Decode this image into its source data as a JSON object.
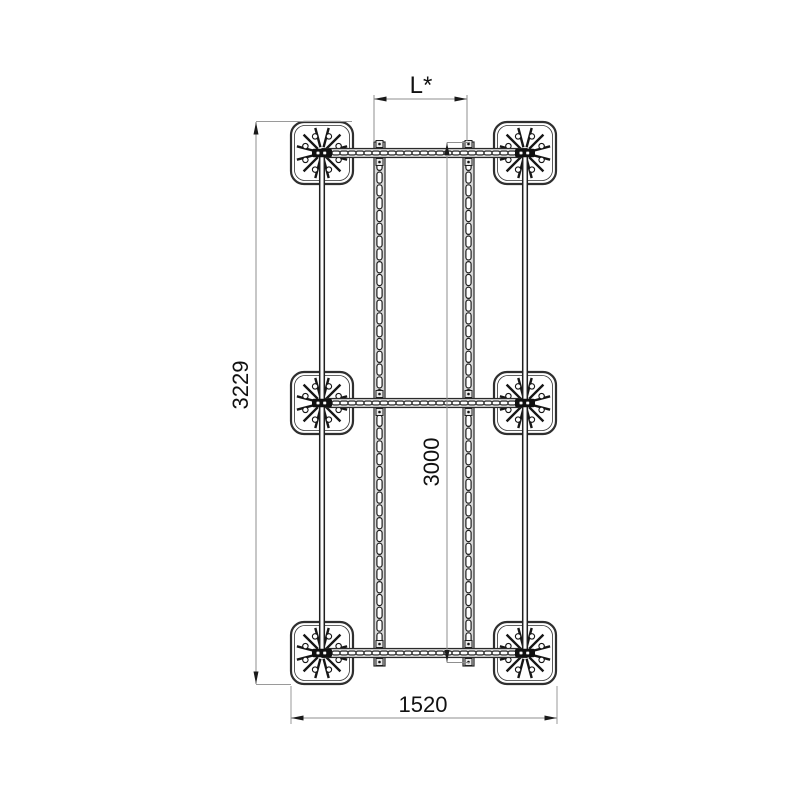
{
  "diagram": {
    "kind": "technical-drawing-top-view",
    "subject": "Mounting frame with six finned base plates, two support tubes and two slotted mounting rails",
    "dimensions": {
      "rail_spacing_top": "L*",
      "overall_length_left": "3229",
      "rail_length_middle": "3000",
      "overall_width_bottom": "1520"
    },
    "colors": {
      "structure_line": "#1f1f1f",
      "rail_fill": "#d8d8d8",
      "dimension_line": "#8f8f8f",
      "text": "#111111",
      "background": "#ffffff"
    }
  }
}
